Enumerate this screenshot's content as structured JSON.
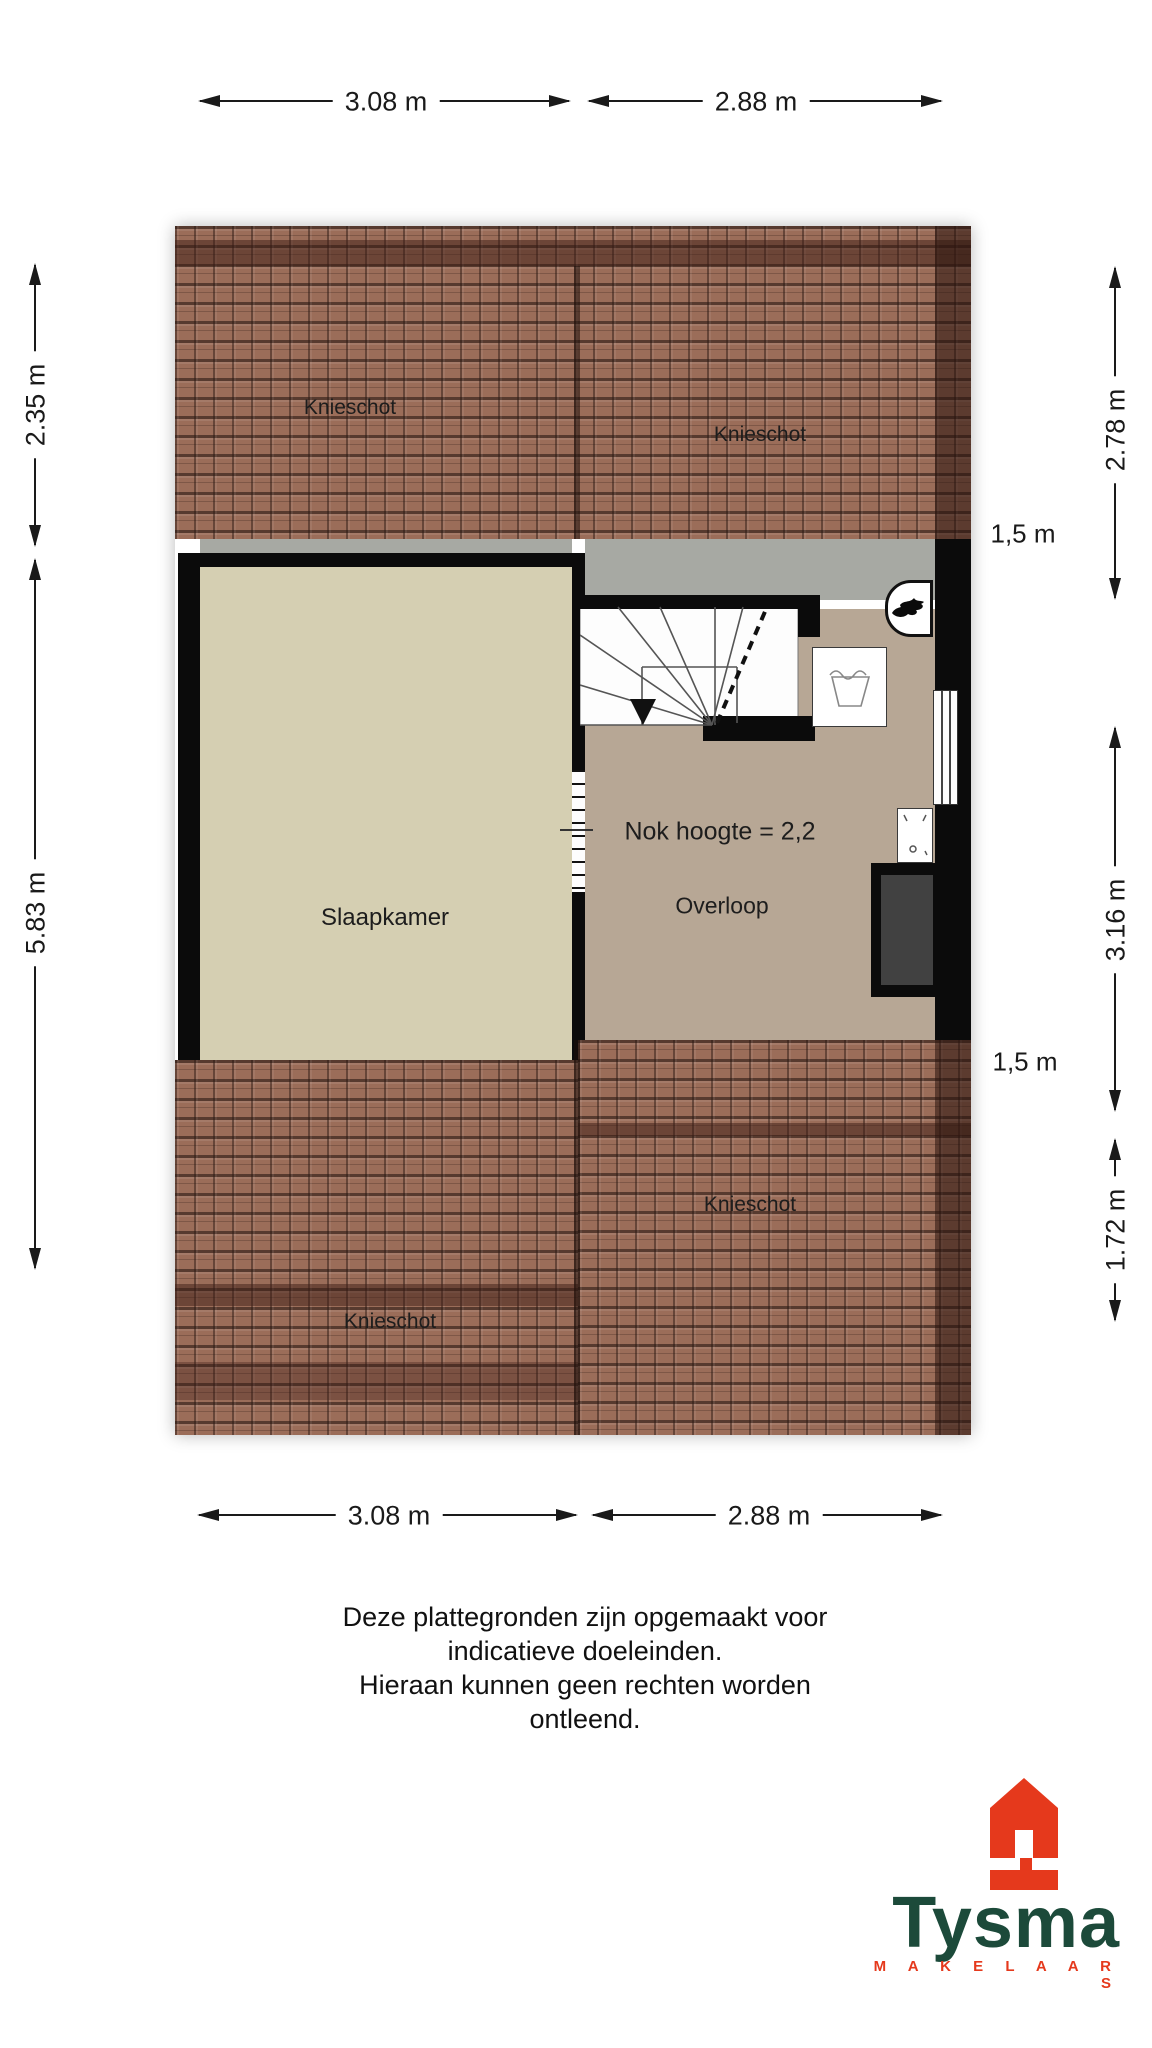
{
  "plan_title": "Verdieping plattegrond",
  "dims": {
    "top_left": "3.08 m",
    "top_right": "2.88 m",
    "bottom_left": "3.08 m",
    "bottom_right": "2.88 m",
    "left_upper": "2.35 m",
    "left_lower": "5.83 m",
    "right_upper": "2.78 m",
    "right_middle": "3.16 m",
    "right_lower": "1.72 m",
    "knee_top": "1,5 m",
    "knee_bottom": "1,5 m"
  },
  "rooms": {
    "bedroom": "Slaapkamer",
    "landing": "Overloop",
    "ridge_note": "Nok hoogte = 2,2",
    "knee_top_left": "Knieschot",
    "knee_top_right": "Knieschot",
    "knee_bottom_right": "Knieschot",
    "knee_bottom_left": "Knieschot"
  },
  "fixtures": {
    "stairs": "trap naar beneden",
    "washbasin": "wastafel",
    "boiler": "cv-ketel",
    "window": "raam",
    "door": "deuropening"
  },
  "disclaimer": {
    "line1": "Deze plattegronden zijn opgemaakt voor indicatieve doeleinden.",
    "line2": "Hieraan kunnen geen rechten worden ontleend."
  },
  "logo": {
    "name": "Tysma",
    "tagline": "M A K E L A A R S"
  },
  "colors": {
    "roof_tile": "#9b6d59",
    "roof_ridge_band": "#5e3422",
    "bedroom_floor": "#d5cfb2",
    "landing_floor": "#b7a795",
    "low_headroom_gray": "#a7a9a3",
    "wall": "#0b0b0b",
    "dark_box": "#414141",
    "logo_green": "#1c4a3a",
    "logo_red": "#e5391c"
  }
}
